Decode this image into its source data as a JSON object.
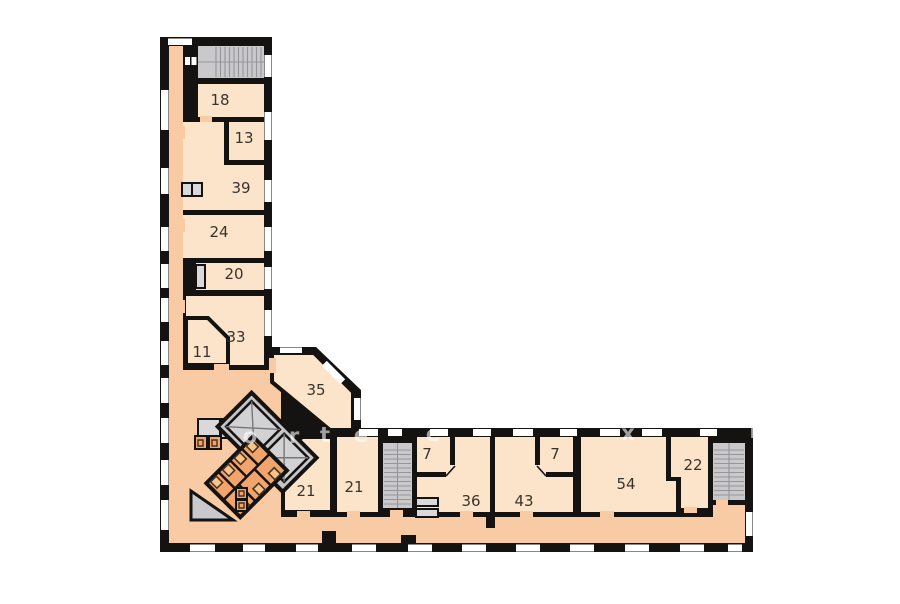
{
  "floor_plan": {
    "rooms": [
      {
        "id": "18",
        "label": "18"
      },
      {
        "id": "13",
        "label": "13"
      },
      {
        "id": "39",
        "label": "39"
      },
      {
        "id": "24",
        "label": "24"
      },
      {
        "id": "20",
        "label": "20"
      },
      {
        "id": "33",
        "label": "33"
      },
      {
        "id": "11",
        "label": "11"
      },
      {
        "id": "35",
        "label": "35"
      },
      {
        "id": "21a",
        "label": "21"
      },
      {
        "id": "21b",
        "label": "21"
      },
      {
        "id": "7a",
        "label": "7"
      },
      {
        "id": "36",
        "label": "36"
      },
      {
        "id": "7b",
        "label": "7"
      },
      {
        "id": "43",
        "label": "43"
      },
      {
        "id": "54",
        "label": "54"
      },
      {
        "id": "22",
        "label": "22"
      }
    ],
    "watermark": {
      "letters": [
        "o",
        "r",
        "t",
        "e",
        "e",
        "x",
        "D"
      ]
    },
    "colors": {
      "background": "#ffffff",
      "wall": "#151311",
      "room": "#fce4cb",
      "corridor": "#f8cba4",
      "stair": "#c9c9cb",
      "tread": "#96969a",
      "elevator": "#c6c6c8",
      "cabin": "#d2d2d4",
      "wc": "#f2a46d",
      "label": "#3a332b",
      "window": "#ffffff"
    }
  }
}
